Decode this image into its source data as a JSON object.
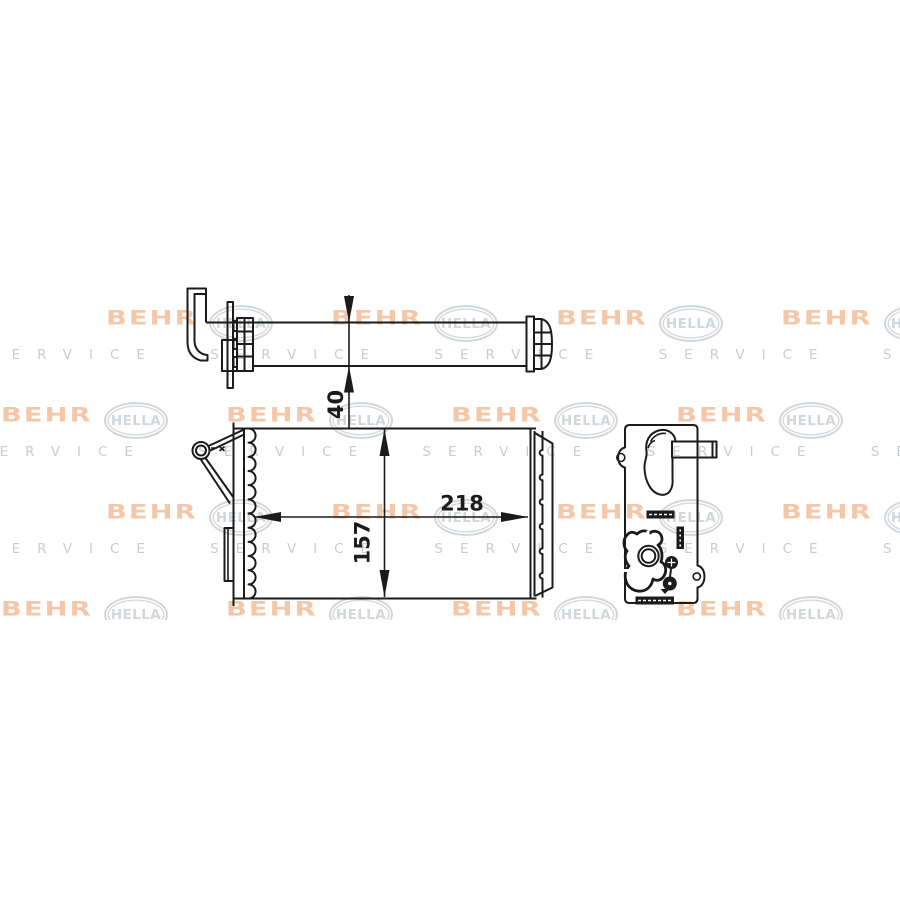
{
  "watermark": {
    "brand_primary": "BEHR",
    "brand_secondary": "HELLA",
    "service_text": "SERVICE",
    "behr_color": "#f3c7a8",
    "hella_color": "#d3d7da",
    "service_color": "#c8cdd1"
  },
  "drawing": {
    "line_color": "#1b1b1b",
    "dimensions": {
      "width": "218",
      "height": "157",
      "depth": "40"
    }
  }
}
